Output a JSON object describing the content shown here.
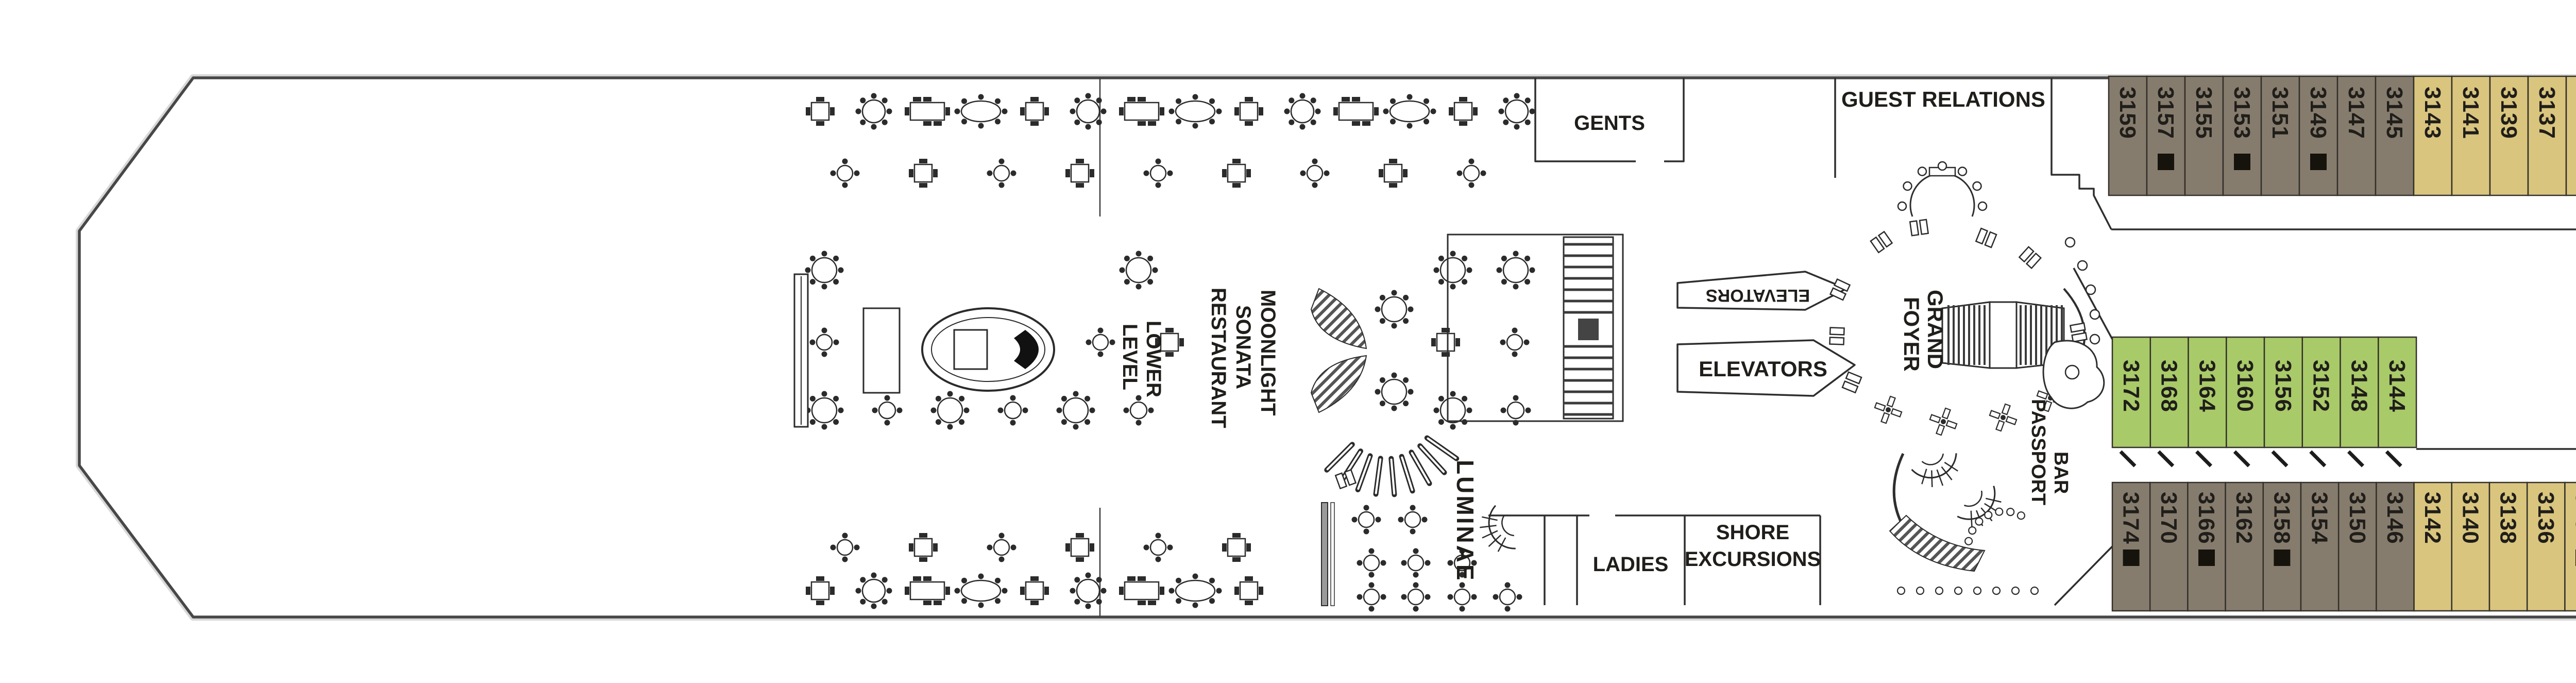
{
  "page": {
    "background": "#ffffff"
  },
  "deck_label": {
    "text": "Deck 3",
    "color": "#1d3b5e"
  },
  "legend": [
    {
      "code": "O1",
      "color": "#867c6d"
    },
    {
      "code": "O2",
      "color": "#d9c57e"
    },
    {
      "code": "I2",
      "color": "#a8ca69"
    }
  ],
  "rooms": {
    "gents": "GENTS",
    "ladies": "LADIES",
    "guest_relations": "GUEST RELATIONS",
    "shore_excursions_line1": "SHORE",
    "shore_excursions_line2": "EXCURSIONS",
    "elevators_mid_top": "ELEVATORS",
    "elevators_mid_bottom": "ELEVATORS",
    "elevators_forward": "ELEVATORS",
    "grand_foyer_word1": "GRAND",
    "grand_foyer_word2": "FOYER",
    "passport_bar_word1": "PASSPORT",
    "passport_bar_word2": "BAR",
    "luminae": "LUMINAE",
    "restaurant_word1": "MOONLIGHT",
    "restaurant_word2": "SONATA",
    "restaurant_word3": "RESTAURANT",
    "lower_level_word1": "LOWER",
    "lower_level_word2": "LEVEL",
    "theatre_word1": "THE",
    "theatre_word2": "THEATRE"
  },
  "icons": {
    "wheelchair": "♿"
  },
  "cabin_categories": {
    "O1": "#867c6d",
    "O2": "#d9c57e",
    "I2": "#a8ca69"
  },
  "cabin_rows": {
    "top": [
      {
        "n": "3159",
        "c": "O1"
      },
      {
        "n": "3157",
        "c": "O1",
        "sofa": true
      },
      {
        "n": "3155",
        "c": "O1"
      },
      {
        "n": "3153",
        "c": "O1",
        "sofa": true
      },
      {
        "n": "3151",
        "c": "O1"
      },
      {
        "n": "3149",
        "c": "O1",
        "sofa": true
      },
      {
        "n": "3147",
        "c": "O1"
      },
      {
        "n": "3145",
        "c": "O1"
      },
      {
        "n": "3143",
        "c": "O2"
      },
      {
        "n": "3141",
        "c": "O2"
      },
      {
        "n": "3139",
        "c": "O2"
      },
      {
        "n": "3137",
        "c": "O2"
      },
      {
        "n": "3135",
        "c": "O2",
        "connect": true
      },
      {
        "n": "3133",
        "c": "O2",
        "sofa": true
      },
      {
        "n": "3131",
        "c": "O2",
        "connect": true
      },
      {
        "n": "3129",
        "c": "O2",
        "sofa": true
      },
      {
        "n": "3127",
        "c": "O2"
      },
      {
        "n": "3125",
        "c": "O2",
        "sofa": true
      },
      {
        "n": "3123",
        "c": "O2"
      },
      {
        "n": "3121",
        "c": "O2",
        "sofa": true
      },
      {
        "n": "3119",
        "c": "O2"
      },
      {
        "n": "3117",
        "c": "O2",
        "sofa": true
      },
      {
        "n": "3115",
        "c": "O2"
      },
      {
        "n": "3111",
        "c": "O2"
      },
      {
        "n": "3109",
        "c": "O2"
      },
      {
        "n": "3107",
        "c": "O2"
      },
      {
        "n": "3105",
        "c": "O2"
      },
      {
        "n": "3103",
        "c": "O2",
        "wc": true
      },
      {
        "n": "3101",
        "c": "O2",
        "wc": true
      }
    ],
    "middle": [
      {
        "n": "3172",
        "c": "I2"
      },
      {
        "n": "3168",
        "c": "I2"
      },
      {
        "n": "3164",
        "c": "I2"
      },
      {
        "n": "3160",
        "c": "I2"
      },
      {
        "n": "3156",
        "c": "I2"
      },
      {
        "n": "3152",
        "c": "I2"
      },
      {
        "n": "3148",
        "c": "I2"
      },
      {
        "n": "3144",
        "c": "I2"
      }
    ],
    "bottom": [
      {
        "n": "3174",
        "c": "O1",
        "sofa": true
      },
      {
        "n": "3170",
        "c": "O1"
      },
      {
        "n": "3166",
        "c": "O1",
        "sofa": true
      },
      {
        "n": "3162",
        "c": "O1"
      },
      {
        "n": "3158",
        "c": "O1",
        "sofa": true
      },
      {
        "n": "3154",
        "c": "O1"
      },
      {
        "n": "3150",
        "c": "O1"
      },
      {
        "n": "3146",
        "c": "O1"
      },
      {
        "n": "3142",
        "c": "O2"
      },
      {
        "n": "3140",
        "c": "O2"
      },
      {
        "n": "3138",
        "c": "O2"
      },
      {
        "n": "3136",
        "c": "O2"
      },
      {
        "n": "3134",
        "c": "O2",
        "sofa": true,
        "connect": true
      },
      {
        "n": "3132",
        "c": "O2"
      },
      {
        "n": "3130",
        "c": "O2",
        "sofa": true,
        "connect": true
      },
      {
        "n": "3128",
        "c": "O2"
      },
      {
        "n": "3126",
        "c": "O2"
      },
      {
        "n": "3124",
        "c": "O2"
      },
      {
        "n": "3122",
        "c": "O2"
      },
      {
        "n": "3120",
        "c": "O2"
      },
      {
        "n": "3118",
        "c": "O2"
      },
      {
        "n": "3116",
        "c": "O2"
      },
      {
        "n": "3114",
        "c": "O2"
      },
      {
        "n": "3112",
        "c": "O2"
      },
      {
        "n": "3110",
        "c": "O2"
      },
      {
        "n": "3108",
        "c": "O2"
      },
      {
        "n": "3106",
        "c": "O2"
      },
      {
        "n": "3104",
        "c": "O2",
        "wc": true
      },
      {
        "n": "3102",
        "c": "O2",
        "wc": true
      }
    ]
  }
}
